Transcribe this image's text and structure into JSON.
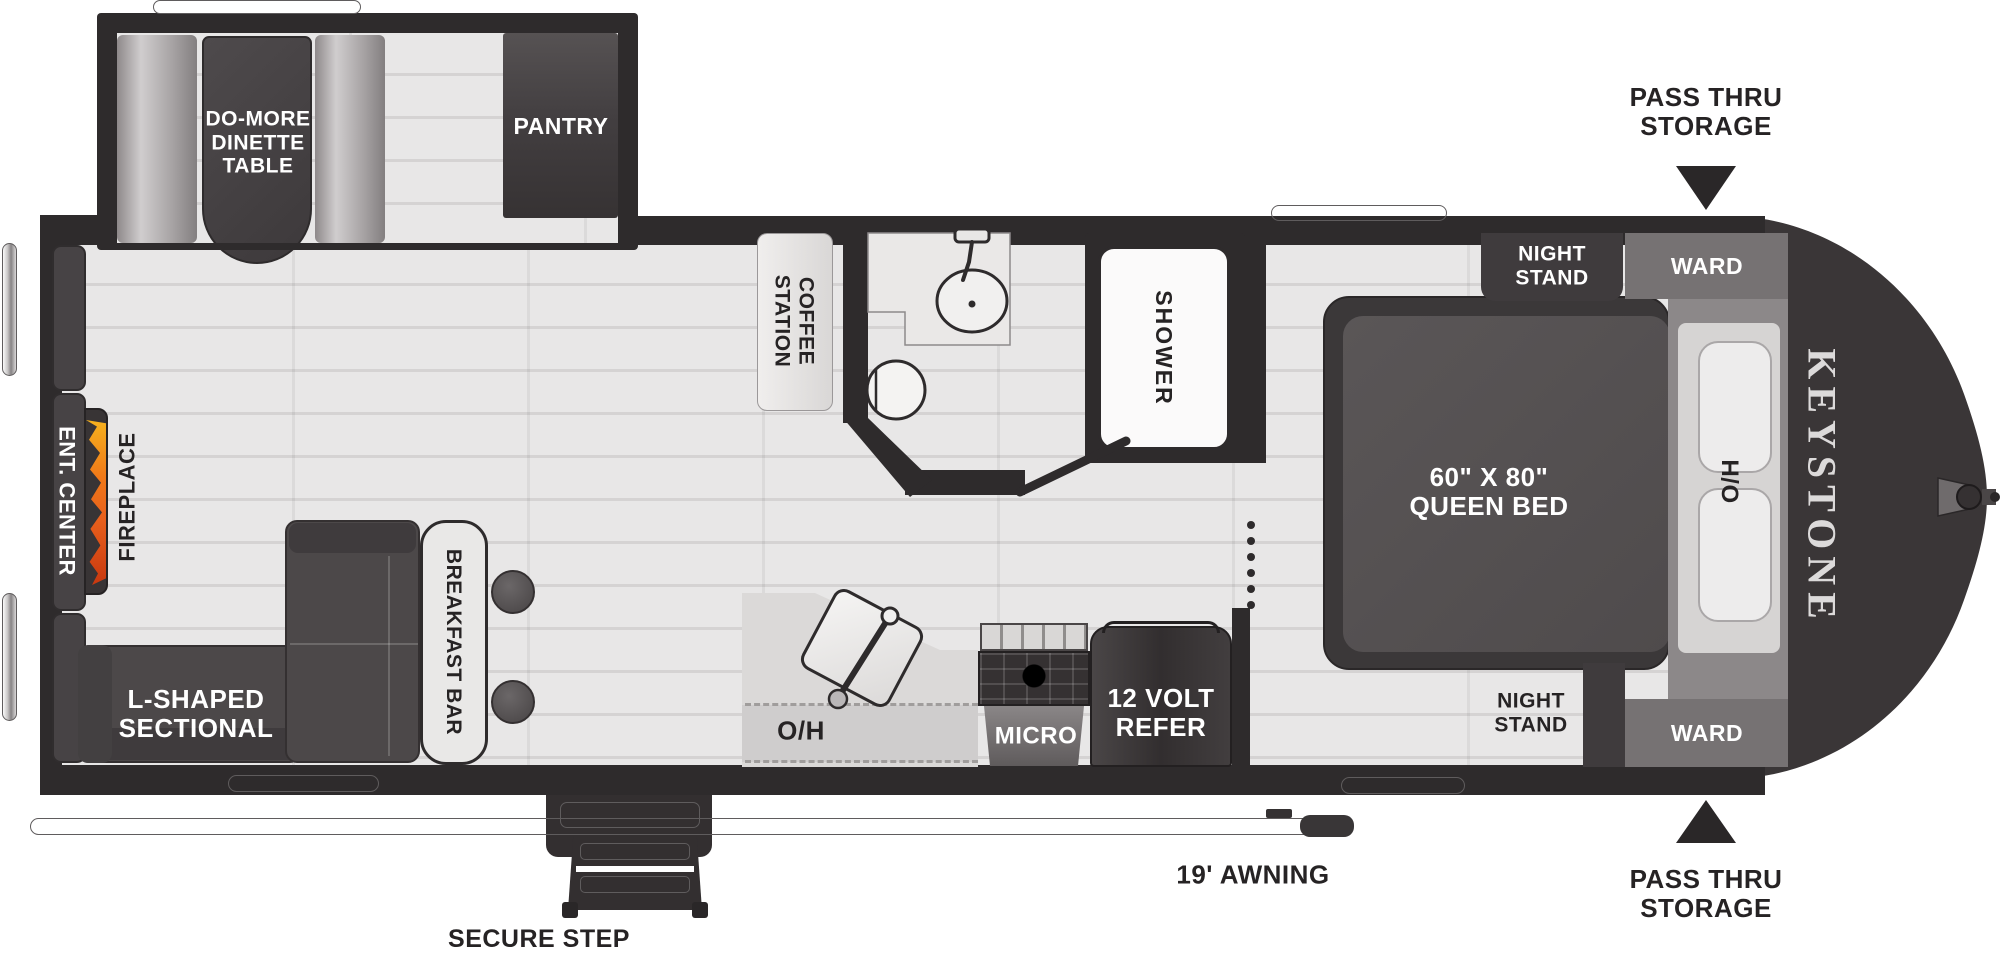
{
  "floorplan": {
    "brand": "KEYSTONE",
    "colors": {
      "wall": "#2e2b2c",
      "floor_light": "#e8e7e7",
      "floor_line": "#d5d3d3",
      "furniture_dark": "#4c4849",
      "cabinet_gray": "#767273",
      "flame_orange": "#e8601c",
      "flame_yellow": "#f6b21e",
      "label_dark": "#262324",
      "label_light": "#ffffff"
    },
    "labels": {
      "dinette": [
        "DO-MORE",
        "DINETTE",
        "TABLE"
      ],
      "pantry": "PANTRY",
      "coffee_station": [
        "COFFEE",
        "STATION"
      ],
      "shower": "SHOWER",
      "night_stand_top": [
        "NIGHT",
        "STAND"
      ],
      "ward_top": "WARD",
      "pass_thru_top": [
        "PASS THRU",
        "STORAGE"
      ],
      "queen_bed": [
        "60\" X 80\"",
        "QUEEN BED"
      ],
      "overhead_bed": "O/H",
      "brand": "KEYSTONE",
      "night_stand_bottom": [
        "NIGHT",
        "STAND"
      ],
      "ward_bottom": "WARD",
      "pass_thru_bottom": [
        "PASS THRU",
        "STORAGE"
      ],
      "awning": "19' AWNING",
      "secure_step": "SECURE STEP",
      "ent_center": "ENT. CENTER",
      "fireplace": "FIREPLACE",
      "sectional": [
        "L-SHAPED",
        "SECTIONAL"
      ],
      "breakfast_bar": "BREAKFAST BAR",
      "overhead_kitchen": "O/H",
      "micro": "MICRO",
      "refer": [
        "12 VOLT",
        "REFER"
      ]
    }
  }
}
